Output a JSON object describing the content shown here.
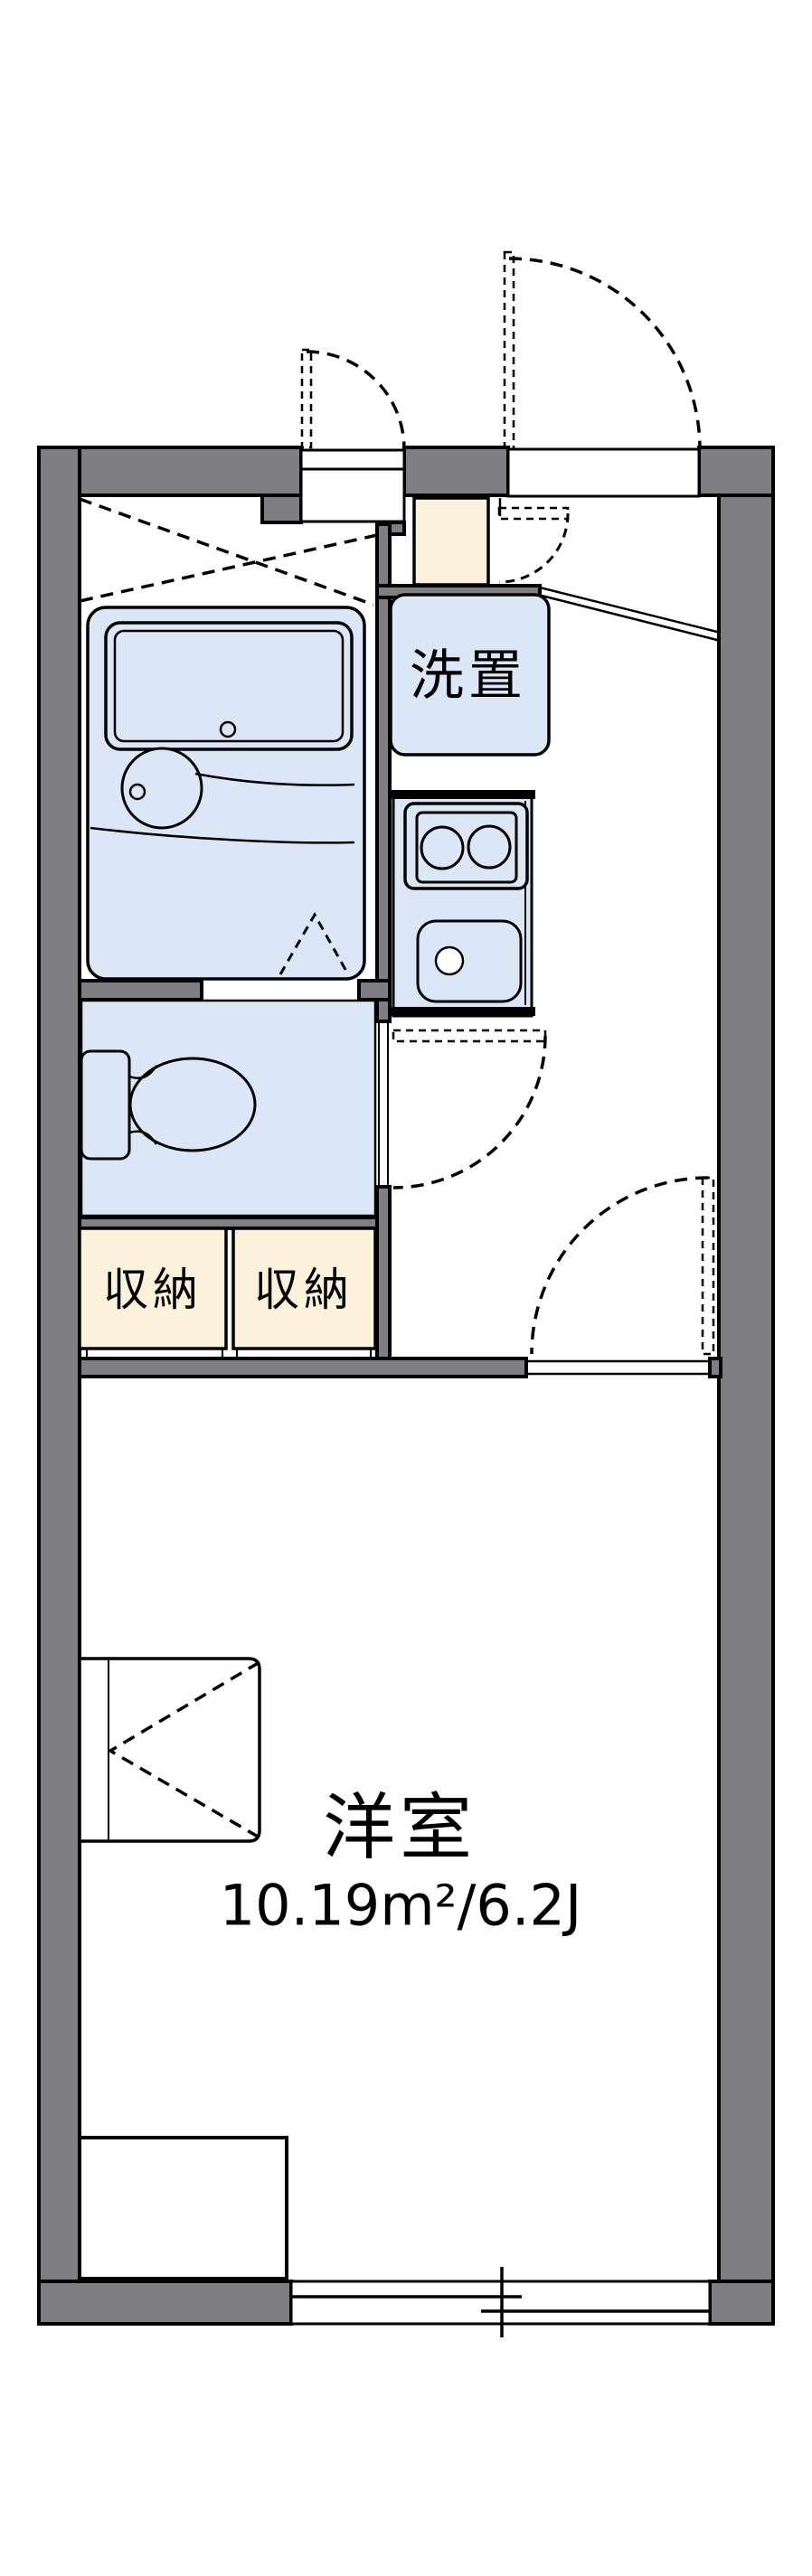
{
  "floorplan": {
    "labels": {
      "washer_space": "洗置",
      "storage_left": "収納",
      "storage_right": "収納",
      "room_name": "洋室",
      "room_area": "10.19m²/6.2J"
    },
    "colors": {
      "wall": "#7e7e83",
      "line": "#000000",
      "fixture": "#dbe7f7",
      "storage": "#fcf1da",
      "bg": "#ffffff"
    }
  }
}
